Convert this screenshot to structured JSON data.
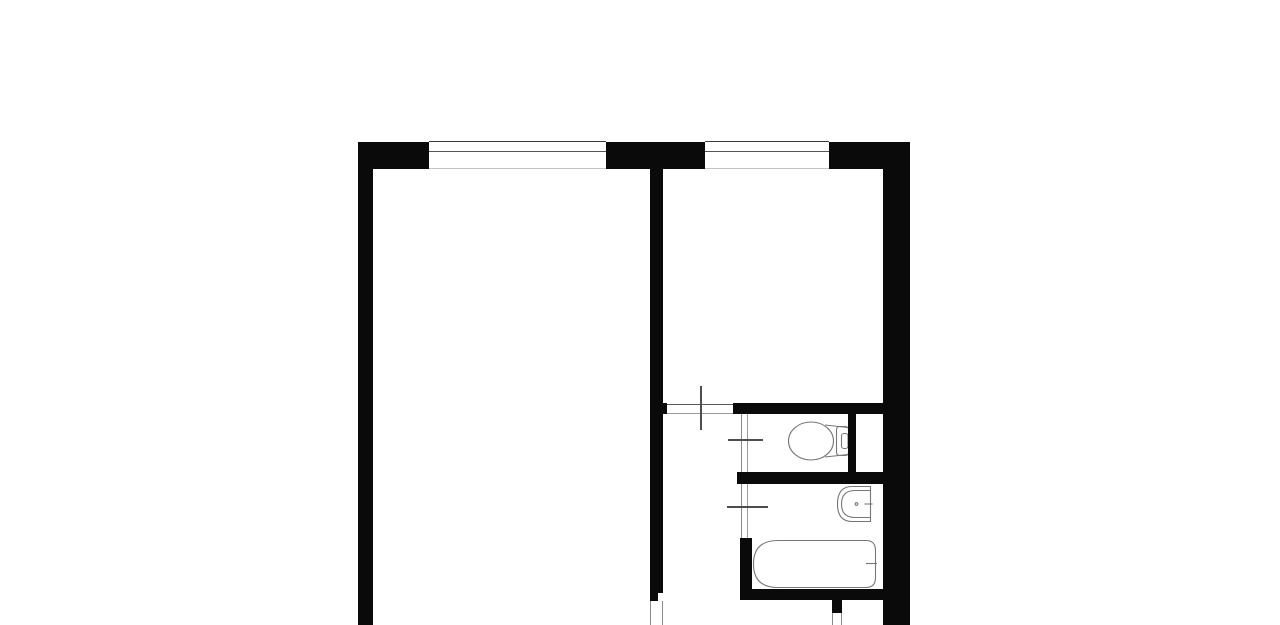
{
  "meta": {
    "description": "apartment-floor-plan",
    "canvas": {
      "width": 1280,
      "height": 625
    },
    "background_color": "#ffffff",
    "wall_color": "#0a0a0a"
  },
  "plan": {
    "wall_color": "#0a0a0a",
    "walls": [
      {
        "name": "top-wall-left-segment",
        "x": 358,
        "y": 142,
        "w": 71,
        "h": 27
      },
      {
        "name": "top-wall-center-pier",
        "x": 606,
        "y": 142,
        "w": 99,
        "h": 27
      },
      {
        "name": "top-wall-right-segment",
        "x": 829,
        "y": 142,
        "w": 81,
        "h": 27
      },
      {
        "name": "left-exterior-wall",
        "x": 358,
        "y": 169,
        "w": 15,
        "h": 456
      },
      {
        "name": "right-exterior-wall",
        "x": 883,
        "y": 169,
        "w": 27,
        "h": 456
      },
      {
        "name": "interior-wall-vertical",
        "x": 650,
        "y": 169,
        "w": 13,
        "h": 424
      },
      {
        "name": "interior-wall-stub",
        "x": 650,
        "y": 593,
        "w": 8,
        "h": 8
      },
      {
        "name": "hallway-wall-left-stub",
        "x": 650,
        "y": 403,
        "w": 17,
        "h": 11
      },
      {
        "name": "wc-top-wall",
        "x": 733,
        "y": 403,
        "w": 150,
        "h": 11
      },
      {
        "name": "wc-right-wall",
        "x": 848,
        "y": 414,
        "w": 8,
        "h": 58
      },
      {
        "name": "wc-bottom-wall",
        "x": 737,
        "y": 472,
        "w": 146,
        "h": 12
      },
      {
        "name": "bathroom-left-wall",
        "x": 740,
        "y": 538,
        "w": 12,
        "h": 51
      },
      {
        "name": "bathroom-bottom-wall",
        "x": 740,
        "y": 589,
        "w": 143,
        "h": 11
      },
      {
        "name": "entry-wall-stub",
        "x": 832,
        "y": 600,
        "w": 10,
        "h": 13
      }
    ],
    "lines": [
      {
        "name": "window-1-outer-line",
        "x": 429,
        "y": 141,
        "w": 177,
        "h": 1.2,
        "color": "#3a3a3a"
      },
      {
        "name": "window-1-glazing-line",
        "x": 429,
        "y": 150.5,
        "w": 177,
        "h": 1.6,
        "color": "#555555"
      },
      {
        "name": "window-1-inner-line",
        "x": 429,
        "y": 167.5,
        "w": 177,
        "h": 1.2,
        "color": "#c4c4c4"
      },
      {
        "name": "window-2-outer-line",
        "x": 705,
        "y": 141,
        "w": 124,
        "h": 1.2,
        "color": "#3a3a3a"
      },
      {
        "name": "window-2-glazing-line",
        "x": 705,
        "y": 150.5,
        "w": 124,
        "h": 1.6,
        "color": "#555555"
      },
      {
        "name": "window-2-inner-line",
        "x": 705,
        "y": 167.5,
        "w": 124,
        "h": 1.2,
        "color": "#c4c4c4"
      },
      {
        "name": "room-door-opening-top-line",
        "x": 667,
        "y": 403.5,
        "w": 66,
        "h": 1.1,
        "color": "#5a5a5a"
      },
      {
        "name": "room-door-opening-bottom-line",
        "x": 667,
        "y": 412.5,
        "w": 66,
        "h": 1.1,
        "color": "#9a9a9a"
      },
      {
        "name": "room-door-leaf",
        "x": 700,
        "y": 386,
        "w": 2.4,
        "h": 44,
        "color": "#4d4d4d"
      },
      {
        "name": "wc-door-jamb-outer",
        "x": 740.8,
        "y": 414,
        "w": 1.1,
        "h": 58,
        "color": "#8a8a8a"
      },
      {
        "name": "wc-door-jamb-inner",
        "x": 747.3,
        "y": 414,
        "w": 1.1,
        "h": 58,
        "color": "#9a9a9a"
      },
      {
        "name": "wc-door-leaf",
        "x": 728,
        "y": 438.8,
        "w": 35,
        "h": 2.4,
        "color": "#4d4d4d"
      },
      {
        "name": "bath-door-jamb-outer",
        "x": 740.8,
        "y": 484,
        "w": 1.1,
        "h": 54,
        "color": "#8a8a8a"
      },
      {
        "name": "bath-door-jamb-inner",
        "x": 747.3,
        "y": 484,
        "w": 1.1,
        "h": 54,
        "color": "#9a9a9a"
      },
      {
        "name": "bath-door-leaf",
        "x": 727,
        "y": 505.8,
        "w": 41,
        "h": 2.4,
        "color": "#4d4d4d"
      },
      {
        "name": "hall-bottom-door-jamb-left",
        "x": 650.3,
        "y": 601,
        "w": 1.1,
        "h": 24,
        "color": "#8a8a8a"
      },
      {
        "name": "hall-bottom-door-jamb-right",
        "x": 661.6,
        "y": 601,
        "w": 1.1,
        "h": 24,
        "color": "#8a8a8a"
      },
      {
        "name": "entry-door-jamb-left",
        "x": 832.3,
        "y": 613,
        "w": 1.1,
        "h": 12,
        "color": "#8a8a8a"
      },
      {
        "name": "entry-door-jamb-right",
        "x": 841.0,
        "y": 613,
        "w": 1.1,
        "h": 12,
        "color": "#8a8a8a"
      }
    ],
    "fixtures": [
      {
        "name": "toilet-bowl",
        "type": "ellipse",
        "attrs": {
          "cx": 811,
          "cy": 441,
          "rx": 22.5,
          "ry": 19
        }
      },
      {
        "name": "toilet-outline-top",
        "type": "path",
        "attrs": {
          "d": "M 825 425 L 848 427.5"
        }
      },
      {
        "name": "toilet-outline-bottom",
        "type": "path",
        "attrs": {
          "d": "M 825 457 L 848 454.5"
        }
      },
      {
        "name": "toilet-cistern",
        "type": "rect",
        "attrs": {
          "x": 836.5,
          "y": 426.5,
          "width": 12,
          "height": 29,
          "rx": 3
        }
      },
      {
        "name": "toilet-cistern-button",
        "type": "rect",
        "attrs": {
          "x": 841.5,
          "y": 433.5,
          "width": 6.5,
          "height": 15,
          "rx": 2.5
        }
      },
      {
        "name": "sink-outline",
        "type": "path",
        "attrs": {
          "d": "M 870.5 486.5 L 852 486.5 Q 837.5 486.5 837.5 504 Q 837.5 521.5 852 521.5 L 870.5 521.5 L 870.5 486.5 Z"
        }
      },
      {
        "name": "sink-inner-line",
        "type": "path",
        "attrs": {
          "d": "M 870.5 490.5 L 855 490.5 Q 841.5 490.5 841.5 504 Q 841.5 517.5 855 517.5 L 870.5 517.5",
          "stroke": "#999999"
        }
      },
      {
        "name": "sink-drain-dot",
        "type": "circle",
        "attrs": {
          "cx": 856.5,
          "cy": 504,
          "r": 1.3,
          "fill": "#666666",
          "stroke": "none"
        }
      },
      {
        "name": "sink-faucet-mark",
        "type": "line",
        "attrs": {
          "x1": 864.5,
          "y1": 504,
          "x2": 872.5,
          "y2": 504,
          "stroke": "#222222",
          "stroke-width": 3
        }
      },
      {
        "name": "bathtub-outline",
        "type": "path",
        "attrs": {
          "d": "M 866 540.5 L 778 540.5 Q 753.5 540.5 753.5 564 Q 753.5 587.5 778 587.5 L 866 587.5 Q 875.5 587.5 875.5 577.5 L 875.5 550.5 Q 875.5 540.5 866 540.5 Z"
        }
      },
      {
        "name": "bathtub-faucet-mark",
        "type": "line",
        "attrs": {
          "x1": 866,
          "y1": 563.5,
          "x2": 877,
          "y2": 563.5,
          "stroke": "#222222",
          "stroke-width": 2.5
        }
      }
    ]
  }
}
